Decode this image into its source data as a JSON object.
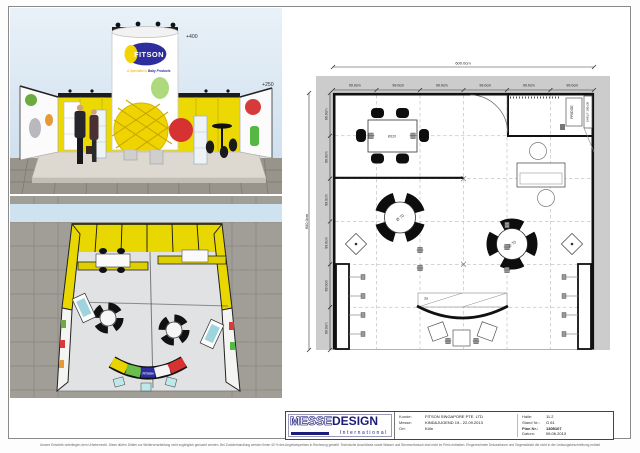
{
  "sheet": {
    "disclaimer": "Unsere Entwürfe unterliegen dem Urheberrecht. Diese dürfen Dritten zur Weiterverarbeitung nicht zugänglich gemacht werden. Bei Zuwiderhandlung werden Ihnen 40 % des Angebotspreises in Rechnung gestellt. Technische Anschlüsse sowie Wasser und Stromverbrauch sind nicht im Preis enthalten. Eingezeichnete Dekorationen und Gegenstände die nicht in der Leistungsbeschreibung enthalten sind, gehören nicht zum Lieferumfang. Änderungen durch die Messe bleiben vorbehalten."
  },
  "front_view": {
    "brand": "FITSON",
    "tagline_left": "A Specialist in",
    "tagline_right": "Baby Products",
    "height_top": "+400",
    "height_side": "+250"
  },
  "top_view": {
    "counter_brand": "FITSON"
  },
  "floor_plan": {
    "overall_top": "600.0cm",
    "overall_left": "600.0cm",
    "top_segments": [
      "99.0cm",
      "99.0cm",
      "99.0cm",
      "99.0cm",
      "99.0cm",
      "99.0cm"
    ],
    "left_segments": [
      "99.0cm",
      "99.0cm",
      "99.0cm",
      "99.0cm",
      "99.0cm",
      "99.0cm"
    ],
    "labels": {
      "fridge": "FRIDGE",
      "shelf": "SHELF 100x30",
      "rect_table": "Ø120",
      "round_table_a": "Ø 70",
      "round_table_b": "Ø 70",
      "counter": "3a"
    }
  },
  "title_block": {
    "logo_messe": "MESSE",
    "logo_design": "DESIGN",
    "logo_sub": "International",
    "left_fields": [
      {
        "label": "Kunde:",
        "value": "FITSON SINGAPORE PTE. LTD"
      },
      {
        "label": "Messe:",
        "value": "KIND&JUGEND  19.- 22.09.2013"
      },
      {
        "label": "Ort:",
        "value": "Köln"
      }
    ],
    "right_fields": [
      {
        "label": "Halle:",
        "value": "11.2"
      },
      {
        "label": "Stand Nr.:",
        "value": "G 61"
      },
      {
        "label": "Plan Nr.:",
        "value": "1305107"
      },
      {
        "label": "Datum:",
        "value": "06.06.2013"
      }
    ]
  }
}
